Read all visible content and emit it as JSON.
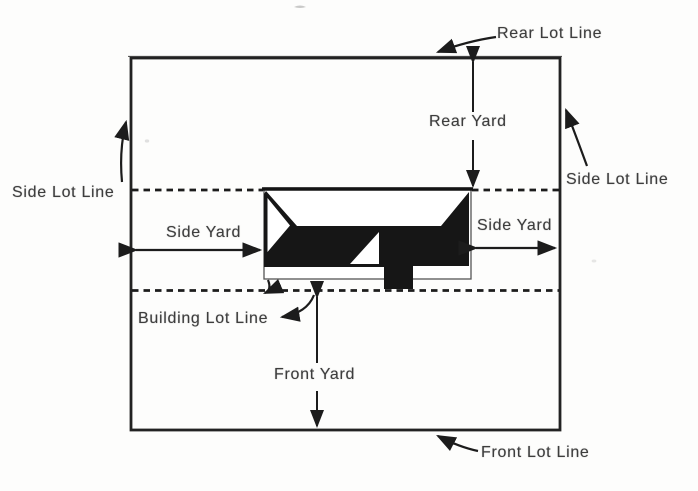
{
  "diagram": {
    "type": "zoning-lot-setback-diagram",
    "labels": {
      "rear_lot_line": "Rear Lot Line",
      "side_lot_line_left": "Side Lot Line",
      "side_lot_line_right": "Side Lot Line",
      "rear_yard": "Rear Yard",
      "side_yard_left": "Side Yard",
      "side_yard_right": "Side Yard",
      "building_lot_line": "Building Lot Line",
      "front_yard": "Front Yard",
      "front_lot_line": "Front Lot Line"
    },
    "colors": {
      "ink": "#1c1c1c",
      "building_fill": "#161616",
      "paper": "#fdfdfc"
    }
  }
}
